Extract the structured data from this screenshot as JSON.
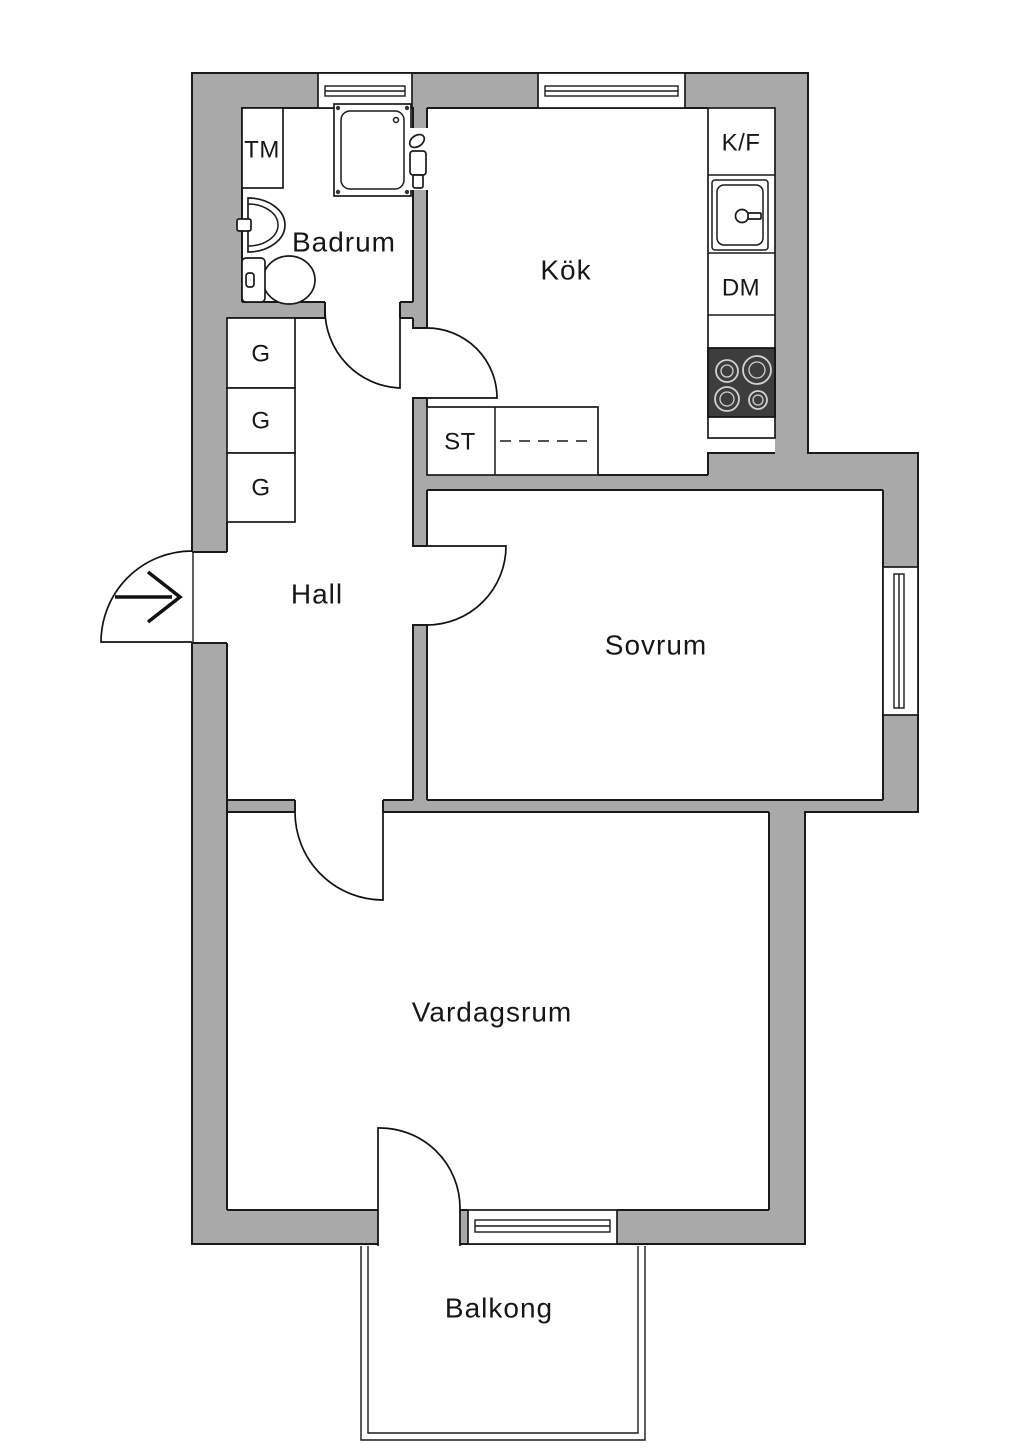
{
  "plan": {
    "title": "Apartment floor plan",
    "rooms": {
      "badrum": "Badrum",
      "kok": "Kök",
      "hall": "Hall",
      "sovrum": "Sovrum",
      "vardagsrum": "Vardagsrum",
      "balkong": "Balkong"
    },
    "fixtures": {
      "washing_machine": "TM",
      "fridge_freezer": "K/F",
      "dishwasher": "DM",
      "closet": "ST",
      "wardrobes": [
        "G",
        "G",
        "G"
      ]
    },
    "colors": {
      "wall": "#a9a9a9",
      "line": "#1a1a1a",
      "stove": "#3d3d3d",
      "floor": "#ffffff"
    }
  }
}
